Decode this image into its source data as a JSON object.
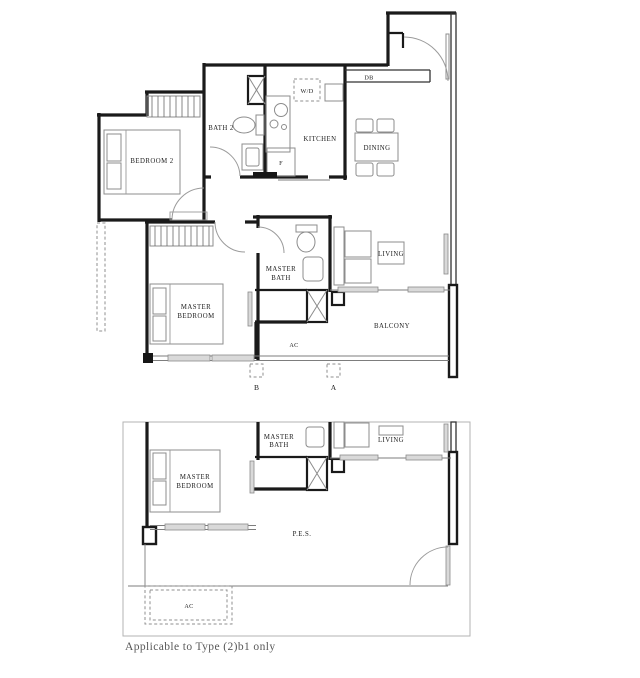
{
  "colors": {
    "wall": "#1a1a1a",
    "furniture": "#8c8c8c",
    "text": "#1c1c1c",
    "plan_border": "#b3b3b3",
    "background": "#ffffff"
  },
  "upper_plan": {
    "labels": {
      "bedroom2": "BEDROOM 2",
      "bath2": "BATH 2",
      "wd": "W/D",
      "db": "DB",
      "kitchen": "KITCHEN",
      "dining": "DINING",
      "fridge": "F",
      "master_bath_line1": "MASTER",
      "master_bath_line2": "BATH",
      "master_bedroom_line1": "MASTER",
      "master_bedroom_line2": "BEDROOM",
      "living": "LIVING",
      "balcony": "BALCONY",
      "ac": "AC",
      "marker_b": "B",
      "marker_a": "A"
    }
  },
  "lower_plan": {
    "labels": {
      "master_bath_line1": "MASTER",
      "master_bath_line2": "BATH",
      "master_bedroom_line1": "MASTER",
      "master_bedroom_line2": "BEDROOM",
      "living": "LIVING",
      "pes": "P.E.S.",
      "ac": "AC"
    }
  },
  "caption": {
    "text": "Applicable to Type (2)b1 only"
  }
}
